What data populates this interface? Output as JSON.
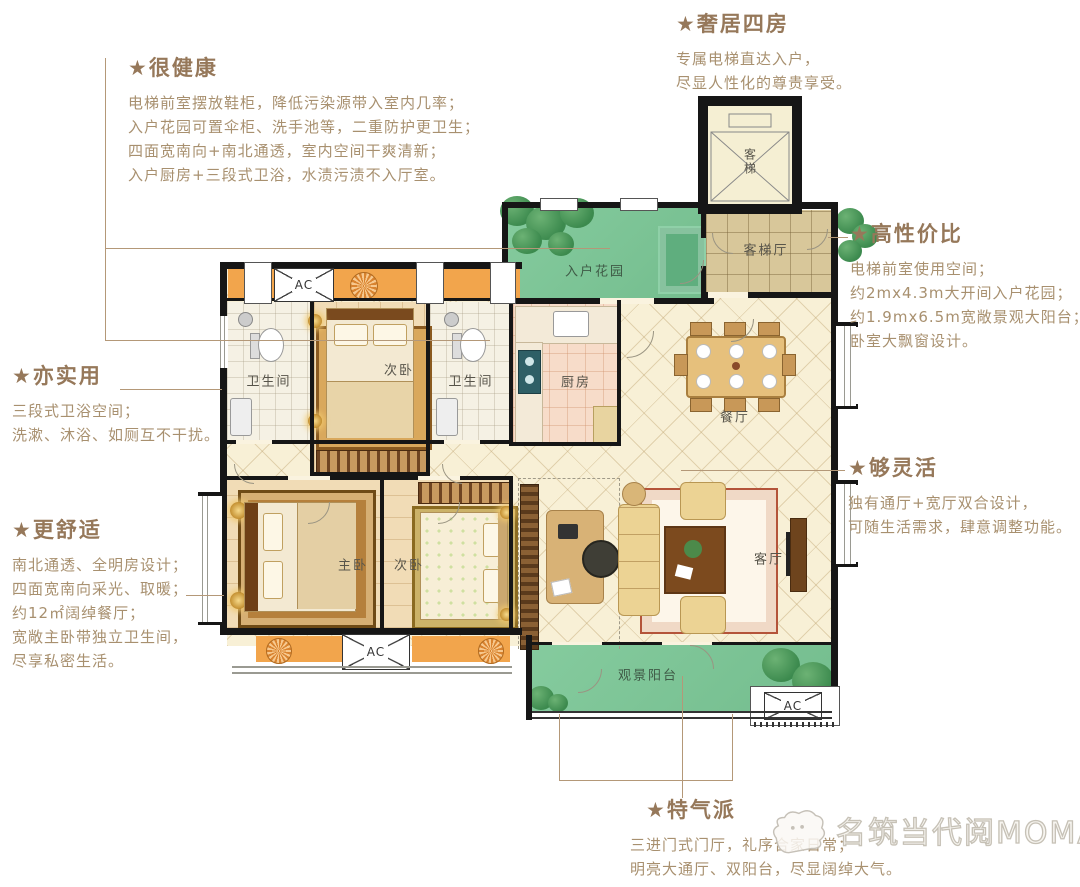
{
  "annotations": {
    "healthy": {
      "title": "★很健康",
      "lines": [
        "电梯前室摆放鞋柜，降低污染源带入室内几率；",
        "入户花园可置伞柜、洗手池等，二重防护更卫生；",
        "四面宽南向+南北通透，室内空间干爽清新；",
        "入户厨房+三段式卫浴，水渍污渍不入厅室。"
      ]
    },
    "luxury_four_rooms": {
      "title": "★奢居四房",
      "lines": [
        "专属电梯直达入户，",
        "尽显人性化的尊贵享受。"
      ]
    },
    "cost_effective": {
      "title": "★高性价比",
      "lines": [
        "电梯前室使用空间；",
        "约2mx4.3m大开间入户花园；",
        "约1.9mx6.5m宽敞景观大阳台；",
        "卧室大飘窗设计。"
      ]
    },
    "practical": {
      "title": "★亦实用",
      "lines": [
        "三段式卫浴空间；",
        "洗漱、沐浴、如厕互不干扰。"
      ]
    },
    "comfortable": {
      "title": "★更舒适",
      "lines": [
        "南北通透、全明房设计；",
        "四面宽南向采光、取暖；",
        "约12㎡阔绰餐厅；",
        "宽敞主卧带独立卫生间，",
        "尽享私密生活。"
      ]
    },
    "flexible": {
      "title": "★够灵活",
      "lines": [
        "独有通厅+宽厅双合设计，",
        "可随生活需求，肆意调整功能。"
      ]
    },
    "grand": {
      "title": "★特气派",
      "lines": [
        "三进门式门厅，礼序合家日常；",
        "明亮大通厅、双阳台，尽显阔绰大气。"
      ]
    }
  },
  "floorplan": {
    "ac_label": "AC",
    "rooms": {
      "bathroom_north_west": "卫生间",
      "bedroom_north": "次卧",
      "bathroom_north_east": "卫生间",
      "kitchen": "厨房",
      "entry_garden": "入户花园",
      "elevator_hall": "客梯厅",
      "elevator": "客梯",
      "dining": "餐厅",
      "master_bedroom": "主卧",
      "bedroom_south": "次卧",
      "living": "客厅",
      "view_balcony": "观景阳台"
    }
  },
  "watermark": {
    "brand": "名筑当代阅MOMA"
  },
  "colors": {
    "annotation_title": "#96785a",
    "annotation_body": "#a8906f",
    "leader_line": "#b49878",
    "wall": "#161616",
    "garden_green": "#7cc498",
    "bay_orange": "#f2a54c",
    "watermark_gray": "#c6c1b6"
  }
}
